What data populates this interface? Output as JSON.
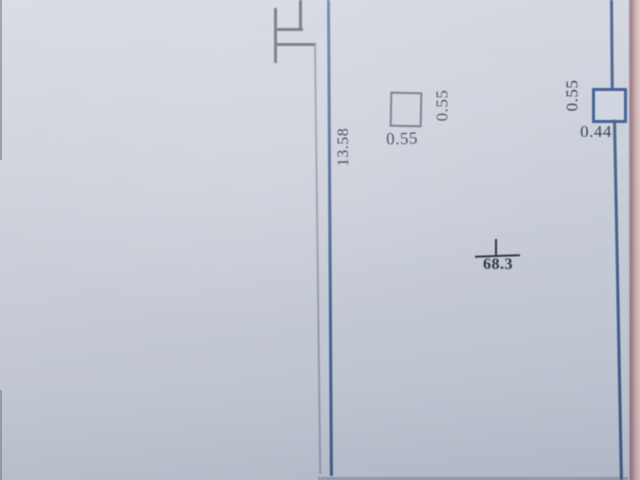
{
  "drawing": {
    "title": "floor-plan-sketch-photo",
    "labels": {
      "left_vertical_dim": "13.58",
      "mid_square_side_dim": "0.55",
      "mid_square_bottom_dim": "0.55",
      "right_square_side_dim": "0.55",
      "right_square_bottom_dim": "0.44",
      "room_area": "68.3"
    },
    "colors": {
      "paper": "#ccd1dc",
      "ink_blue": "#47648f",
      "pencil_gray": "#717987",
      "text_dark": "#333d55",
      "area_text": "#2c3443",
      "photo_edge_pink": "#d3b5b4",
      "photo_edge_maroon": "#967a85"
    }
  }
}
